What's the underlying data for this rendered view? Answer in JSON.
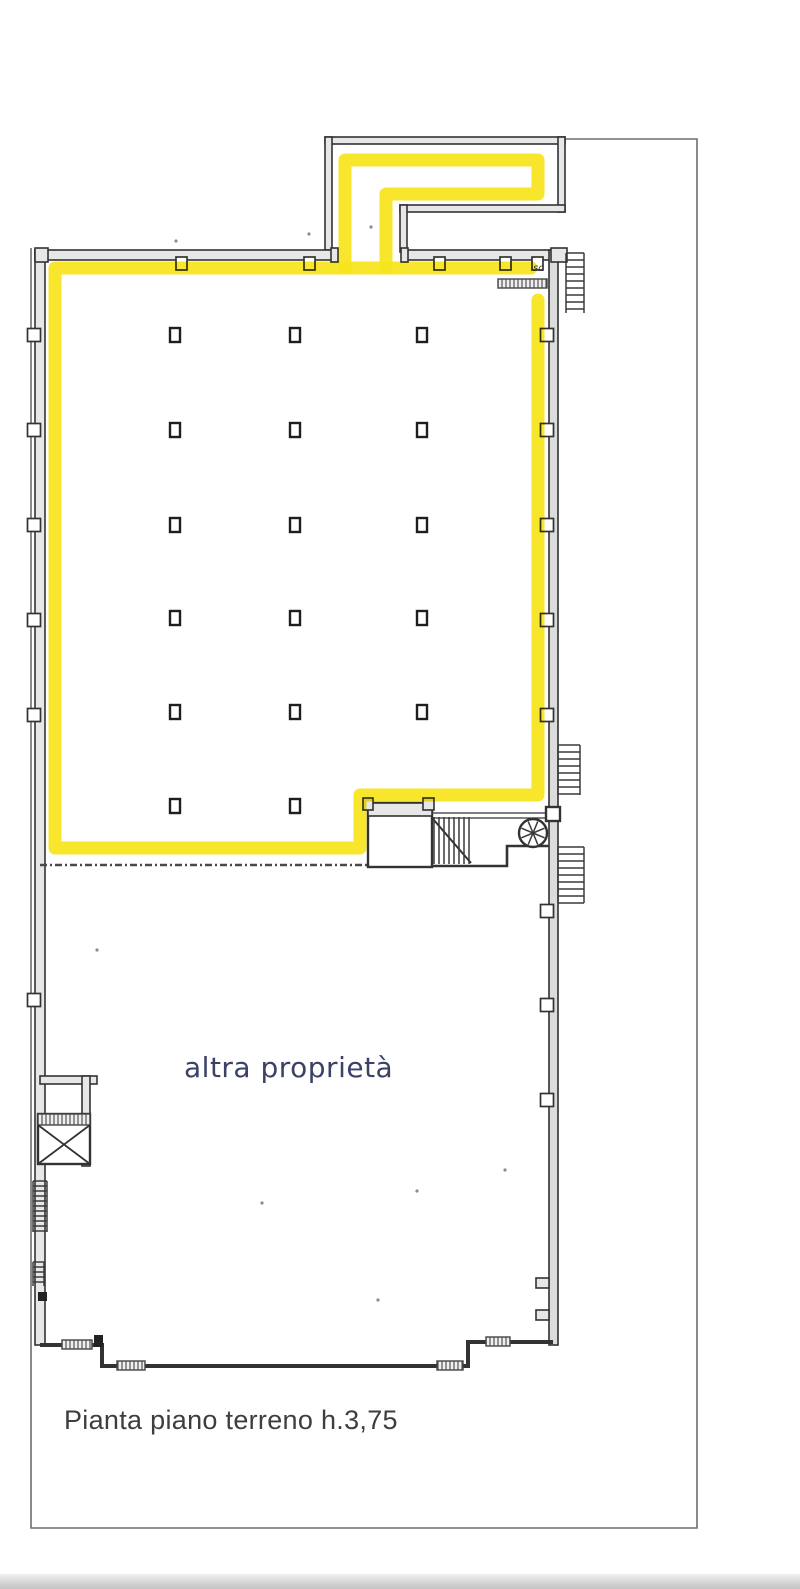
{
  "labels": {
    "other_property": "altra proprietà",
    "plan_title": "Pianta piano terreno h.3,75",
    "stair_abbr": "sc"
  },
  "colors": {
    "highlight_yellow": "#F6E41C",
    "ink": "#333333",
    "boundary_gray": "#6e6e6e",
    "label_blue": "#3c4168",
    "label_gray": "#3e3e3e"
  },
  "highlight": {
    "stroke_width": 13,
    "segments": [
      [
        [
          345,
          268
        ],
        [
          345,
          160
        ],
        [
          538,
          160
        ],
        [
          538,
          194
        ],
        [
          386,
          194
        ],
        [
          386,
          268
        ]
      ],
      [
        [
          531,
          268
        ],
        [
          55,
          268
        ],
        [
          55,
          848
        ],
        [
          360,
          848
        ],
        [
          360,
          795
        ],
        [
          538,
          795
        ],
        [
          538,
          300
        ]
      ]
    ]
  },
  "structure": {
    "columns": {
      "cols_x": [
        175,
        295,
        422
      ],
      "rows_y": [
        335,
        430,
        525,
        618,
        712,
        806
      ],
      "skip": [
        [
          422,
          806
        ]
      ],
      "w": 10,
      "h": 14
    },
    "pilasters": {
      "left_x": 34,
      "right_x": 547,
      "size": 13,
      "left_y": [
        335,
        430,
        525,
        620,
        715,
        1000
      ],
      "right_y": [
        335,
        430,
        525,
        620,
        715,
        911,
        1005,
        1100
      ]
    },
    "wall_tabs_x": [
      176,
      304,
      434,
      500,
      532
    ],
    "stair_combs": [
      {
        "x": 566,
        "x2": 584,
        "y": 253,
        "y2": 313,
        "step": 7
      },
      {
        "x": 558,
        "x2": 580,
        "y": 745,
        "y2": 795,
        "step": 7
      },
      {
        "x": 558,
        "x2": 584,
        "y": 847,
        "y2": 903,
        "step": 7
      },
      {
        "x": 33,
        "x2": 47,
        "y": 1181,
        "y2": 1232,
        "step": 5
      },
      {
        "x": 33,
        "x2": 44,
        "y": 1262,
        "y2": 1286,
        "step": 5
      }
    ],
    "treads": {
      "x1": 434,
      "x2": 470,
      "step": 5,
      "y1": 817,
      "y2": 864
    },
    "fan": {
      "cx": 533,
      "cy": 833,
      "r": 14,
      "spokes": 8
    }
  },
  "specks": [
    [
      176,
      241
    ],
    [
      309,
      234
    ],
    [
      371,
      227
    ],
    [
      417,
      1191
    ],
    [
      505,
      1170
    ],
    [
      378,
      1300
    ],
    [
      262,
      1203
    ],
    [
      97,
      950
    ]
  ]
}
